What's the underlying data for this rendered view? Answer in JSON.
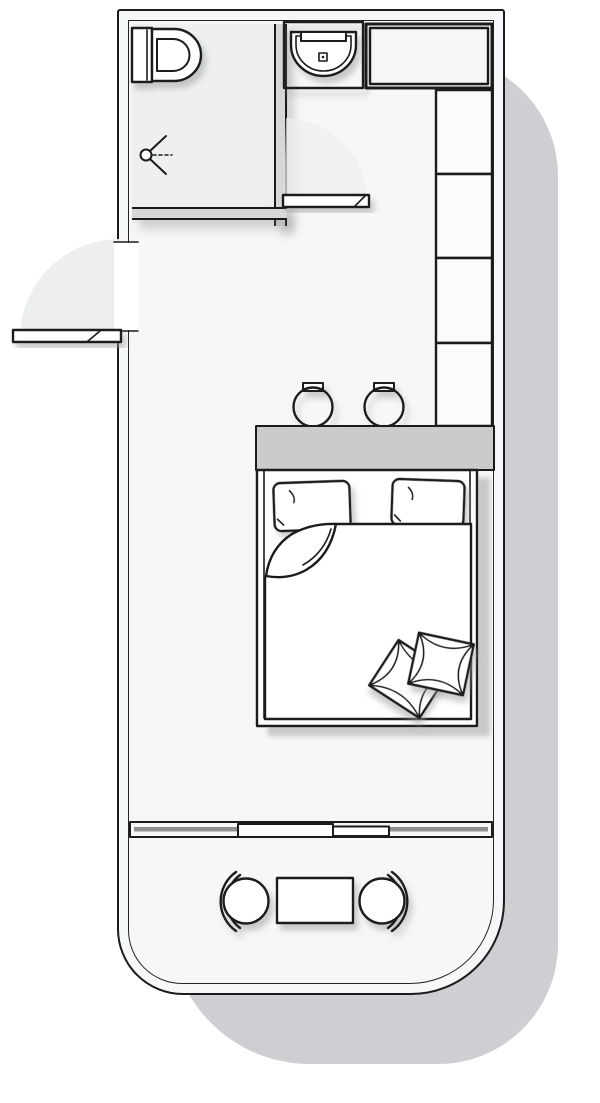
{
  "colors": {
    "line": "#1b1b1b",
    "floor": "#f6f7f8",
    "bath_floor": "#edeff0",
    "wall_fill": "#d5d7d8",
    "headboard": "#c9cbcd",
    "glass": "#8e9092",
    "shadow": "#cdcfd2",
    "swing_area": "#eceef0",
    "furniture_fill": "#ffffff"
  },
  "plan": {
    "label": "Studio room floor plan, top-down line drawing",
    "rooms": {
      "bathroom": "Shower room",
      "bedroom": "Bedroom",
      "balcony": "Balcony"
    },
    "items": {
      "toilet": "Toilet",
      "shower_head": "Shower head",
      "washbasin": "Washbasin vanity",
      "counter": "Countertop cabinet",
      "wardrobe": "Wardrobe with four sections",
      "entry_door": "Entry door swinging outward",
      "bathroom_door": "Bathroom door swinging inward",
      "stool_left": "Left bedside stool",
      "stool_right": "Right bedside stool",
      "headboard": "Headboard ledge",
      "double_bed": "Double bed",
      "pillow_left": "Left pillow",
      "pillow_right": "Right pillow",
      "duvet": "Duvet with folded-back corner",
      "towel_left": "Folded towel",
      "towel_right": "Folded towel",
      "sliding_window": "Sliding balcony door",
      "balcony_chair_left": "Left balcony chair",
      "balcony_chair_right": "Right balcony chair",
      "balcony_table": "Balcony table"
    }
  }
}
